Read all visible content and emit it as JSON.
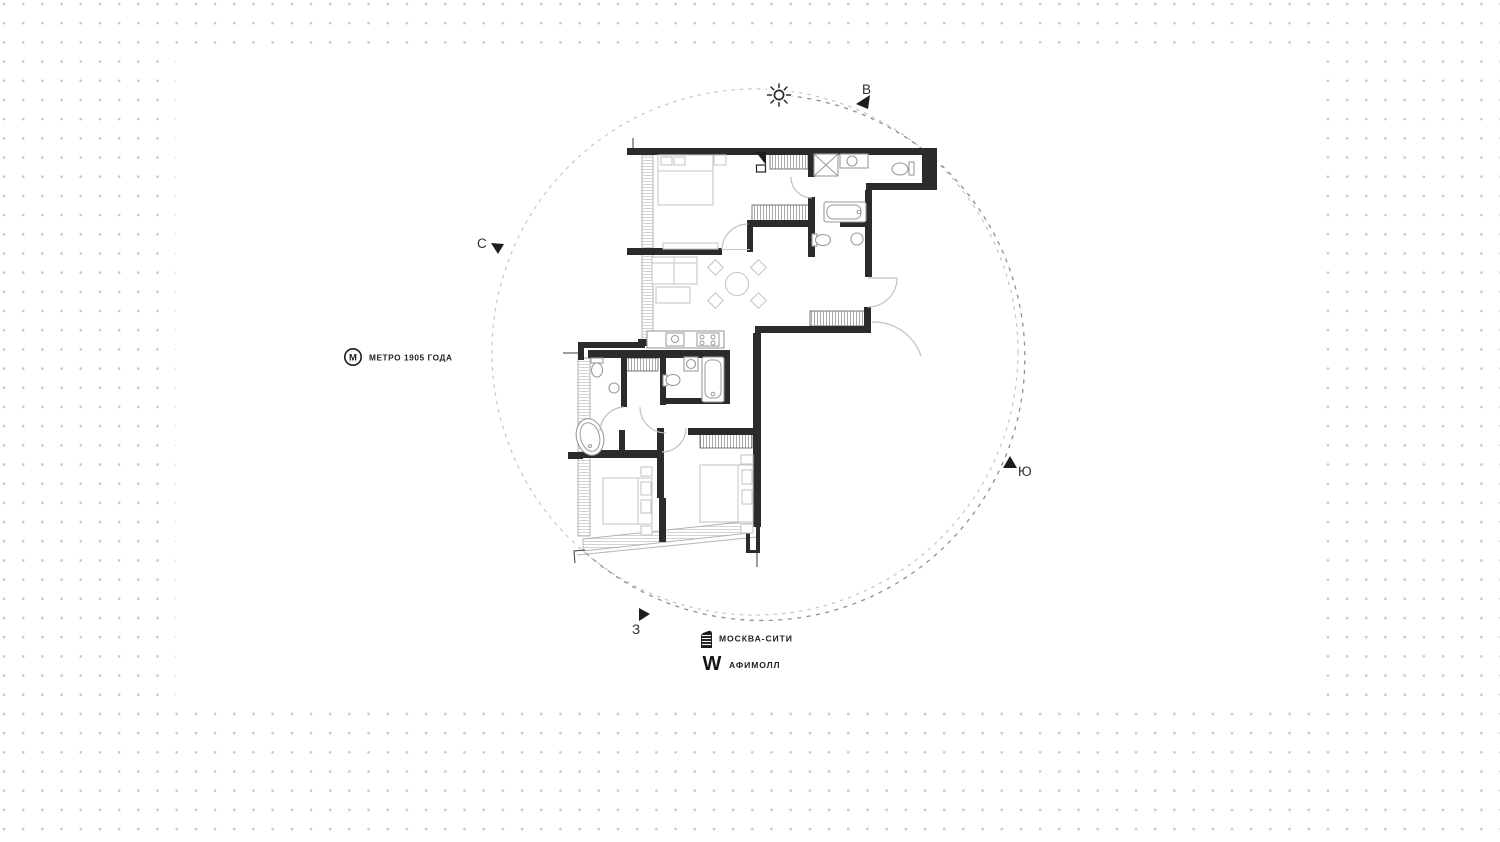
{
  "compass": {
    "north_label": "С",
    "east_label": "В",
    "south_label": "Ю",
    "west_label": "З"
  },
  "landmarks": {
    "metro": {
      "icon_letter": "М",
      "label": "МЕТРО 1905 ГОДА"
    },
    "city": {
      "label": "МОСКВА-СИТИ"
    },
    "mall": {
      "icon_letter": "W",
      "label": "АФИМОЛЛ"
    }
  },
  "colors": {
    "wall": "#2b2b2b",
    "furniture": "#c6c6c6",
    "fixture": "#9a9a9a",
    "arc": "#c0c0c0",
    "hatch": "#a8a8a8",
    "glass": "#c9c9c9",
    "circle_light": "#c6c6c6",
    "circle_dark": "#8f8f8f",
    "ink": "#222222",
    "dot": "#c7c7cb",
    "panel": "#ffffff"
  }
}
